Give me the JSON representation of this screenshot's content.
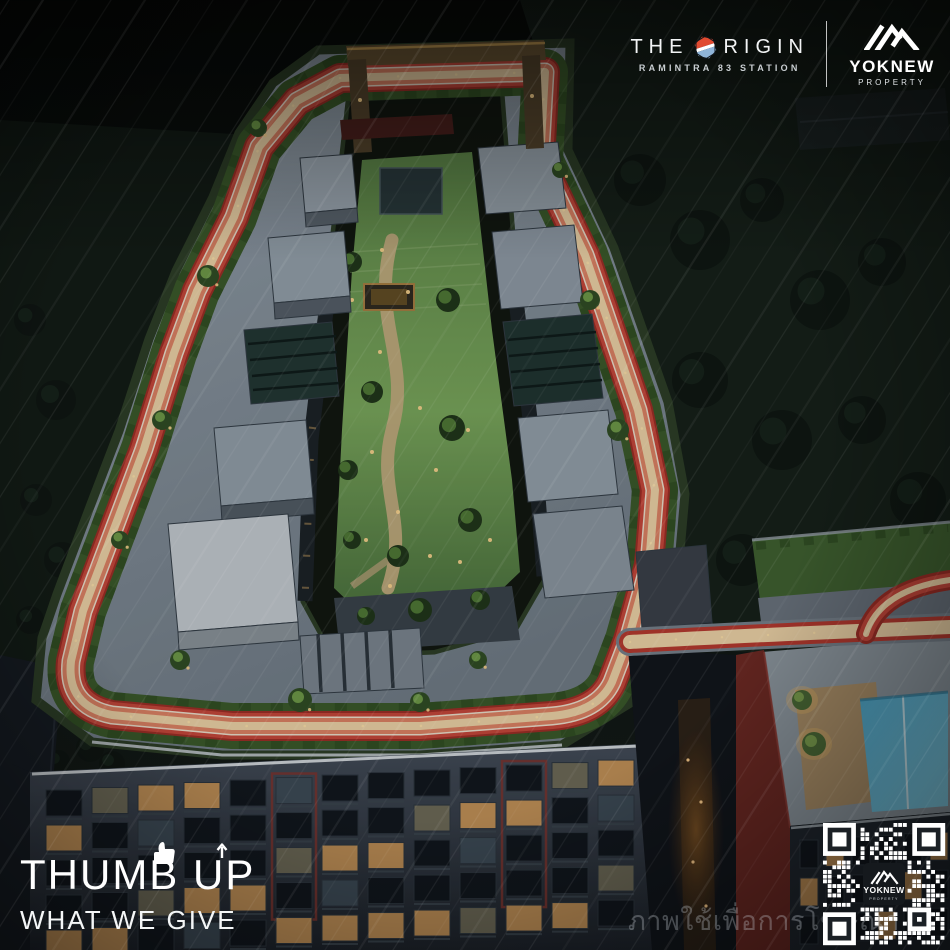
{
  "brand": {
    "origin": {
      "name_prefix": "THE",
      "name_suffix": "RIGIN",
      "station": "RAMINTRA 83 STATION"
    },
    "developer": {
      "name": "YOKNEW",
      "division": "PROPERTY"
    }
  },
  "slogan": {
    "line1": "THUMB UP",
    "line2": "WHAT WE GIVE"
  },
  "watermark": "ภาพใช้เพื่อการโฆษณา",
  "qr_label": {
    "name": "YOKNEW",
    "division": "PROPERTY"
  },
  "icons": {
    "origin_hexagon": "hexagon-badge-red-white-blue",
    "yoknew_mountain": "mountain-peaks",
    "thumb": "thumbs-up",
    "up_arrow": "arrow-up",
    "qr": "qr-code"
  },
  "colors": {
    "track_red": "#c8473a",
    "track_dark": "#9e2d25",
    "track_salmon": "#e08364",
    "track_cream": "#f0d5a8",
    "hedge_green": "#3a5a2a",
    "lawn_green": "#7aa85c",
    "roof_gray": "#8d99a4",
    "facade_gray": "#3c4450",
    "pool_blue": "#5ab4d4",
    "warm_light": "#e8b766",
    "maroon_wall": "#6e2823",
    "night_green": "#16211a",
    "logo_red": "#e04a30",
    "logo_blue": "#8fb4d8"
  }
}
